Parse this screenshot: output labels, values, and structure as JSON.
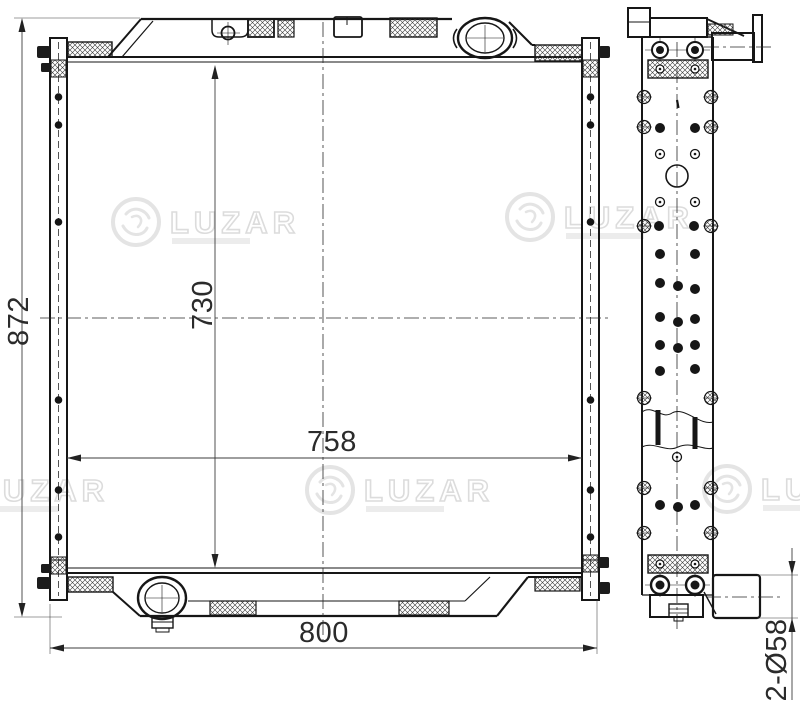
{
  "watermark": {
    "brand": "LUZAR"
  },
  "dimensions": {
    "overall_height": "872",
    "core_height": "730",
    "core_width": "758",
    "overall_width": "800",
    "pipes": "2-Ø58"
  }
}
